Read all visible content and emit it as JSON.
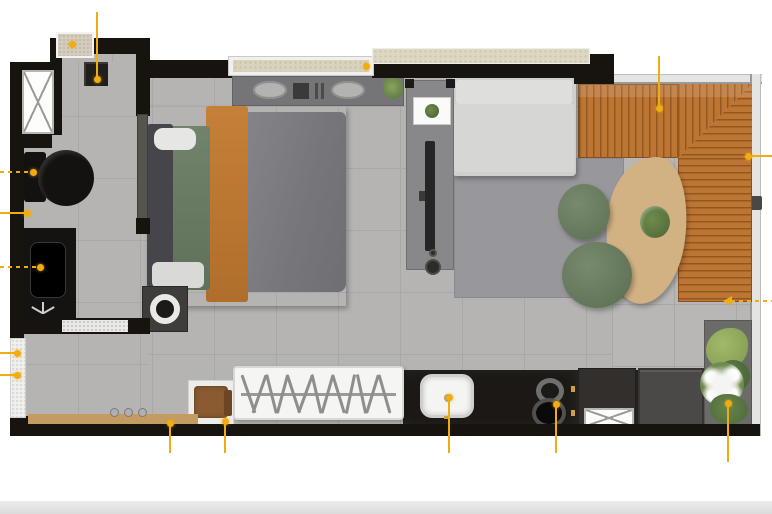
{
  "title": "Studio apartment floor plan, top-down architectural rendering with highlight callouts",
  "palette": {
    "background": "#ffffff",
    "wall": "#17130f",
    "callout_yellow": "#f0ac11",
    "floor_tile": "#b5b4b2",
    "tile_seam": "#a9a8a6",
    "deck_wood": "#bc7533",
    "deck_slat_line": "#94561f",
    "bed_orange_throw": "#c07a35",
    "bed_green_pillows": "#68795f",
    "bed_gray_duvet": "#7d7d80",
    "sofa_gray": "#cfcfcd",
    "rug_gray": "#98979b",
    "coffee_table_beige": "#d2b283",
    "pouf_green": "#6b7f61",
    "counter_black": "#1b1815",
    "cabinet_gray": "#4b4947",
    "hall_bench_wood": "#c49b61",
    "plant_green": "#6f8b4f",
    "fixture_white": "#f4f4f2",
    "curtain_beige": "#d9d3bd"
  },
  "rooms": [
    {
      "name": "entry-hall"
    },
    {
      "name": "bathroom"
    },
    {
      "name": "bedroom-living-area"
    },
    {
      "name": "kitchenette"
    },
    {
      "name": "terrace"
    }
  ],
  "furniture": [
    "entry doormat",
    "entry stool",
    "shower box",
    "toilet",
    "bathroom vanity with sink",
    "bathroom door",
    "washing machine",
    "double bed with orange throw and green pillows",
    "headboard shelf with decor",
    "window with beige curtain",
    "flower ledge above sofa",
    "tv panel with mounted tv and plant tray",
    "sofa",
    "living rug",
    "organic coffee table with plant",
    "green pouf (small)",
    "green pouf (large)",
    "wooden deck bench along top railing",
    "wooden deck bench along right railing",
    "terrace glass railing",
    "terrace planter with white flowers",
    "kitchen counter",
    "kitchen sink",
    "two-burner cooktop",
    "base cabinet with x-front",
    "refrigerator",
    "open wardrobe rail with hangers",
    "desk pad",
    "desk chair",
    "entry hall low wood bench",
    "wall hooks",
    "entry door panel"
  ],
  "wardrobe": {
    "hanger_count": 13
  },
  "callouts": [
    {
      "name": "entry-stool",
      "type": "v",
      "x": 97,
      "y": 79,
      "from": 12,
      "dashed": false
    },
    {
      "name": "entry-doormat",
      "type": "dot",
      "x": 72,
      "y": 44
    },
    {
      "name": "bedroom-window",
      "type": "dot",
      "x": 366,
      "y": 66
    },
    {
      "name": "terrace-bench-top",
      "type": "v",
      "x": 659,
      "y": 108,
      "from": 56,
      "dashed": false
    },
    {
      "name": "terrace-bench-right",
      "type": "h",
      "x": 748,
      "y": 156,
      "from": 772,
      "dashed": false
    },
    {
      "name": "terrace-floor",
      "type": "arrow-h",
      "x": 731,
      "y": 301,
      "from": 772,
      "dashed": true
    },
    {
      "name": "terrace-planter",
      "type": "v",
      "x": 728,
      "y": 403,
      "from": 462,
      "dashed": false
    },
    {
      "name": "kitchen-sink",
      "type": "v",
      "x": 449,
      "y": 397,
      "from": 453,
      "dashed": false
    },
    {
      "name": "cooktop",
      "type": "v",
      "x": 556,
      "y": 404,
      "from": 453,
      "dashed": false
    },
    {
      "name": "desk-chair",
      "type": "v",
      "x": 225,
      "y": 421,
      "from": 453,
      "dashed": false
    },
    {
      "name": "hall-bench",
      "type": "v",
      "x": 170,
      "y": 423,
      "from": 453,
      "dashed": false
    },
    {
      "name": "toilet",
      "type": "h",
      "x": 33,
      "y": 172,
      "from": 0,
      "dashed": true
    },
    {
      "name": "shower-area",
      "type": "h",
      "x": 27,
      "y": 213,
      "from": 0,
      "dashed": false
    },
    {
      "name": "bathroom-vanity",
      "type": "h",
      "x": 40,
      "y": 267,
      "from": 0,
      "dashed": true
    },
    {
      "name": "entry-door-upper",
      "type": "h",
      "x": 17,
      "y": 353,
      "from": 0,
      "dashed": false
    },
    {
      "name": "entry-door-lower",
      "type": "h",
      "x": 17,
      "y": 375,
      "from": 0,
      "dashed": false
    }
  ]
}
